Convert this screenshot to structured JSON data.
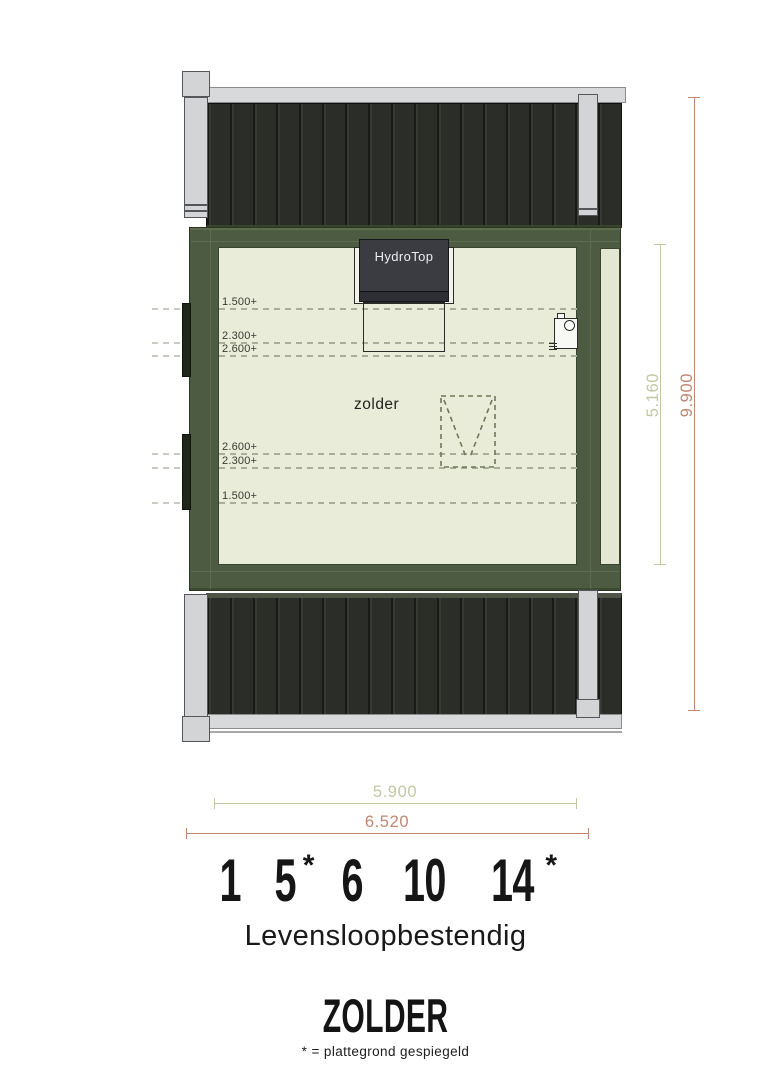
{
  "floorplan": {
    "room_label": "zolder",
    "unit_label": "HydroTop",
    "height_markers": [
      "1.500+",
      "2.300+",
      "2.600+",
      "2.600+",
      "2.300+",
      "1.500+"
    ],
    "dims": {
      "inner_width": "5.900",
      "outer_width": "6.520",
      "inner_depth": "5.160",
      "total_depth": "9.900"
    },
    "colors": {
      "wall_green": "#4c5b41",
      "roof_dark": "#2b2d28",
      "floor_cream": "#e9ecd9",
      "eave_gray": "#d8d9da",
      "dim_olive": "#c3c8a2",
      "dim_salmon": "#c18672"
    }
  },
  "footer": {
    "house_numbers": [
      {
        "value": "1",
        "suffix": ""
      },
      {
        "value": "5",
        "suffix": "*"
      },
      {
        "value": "6",
        "suffix": ""
      },
      {
        "value": "10",
        "suffix": ""
      },
      {
        "value": "14",
        "suffix": "*"
      }
    ],
    "subtitle": "Levensloopbestendig",
    "title": "ZOLDER",
    "footnote": "* = plattegrond gespiegeld"
  }
}
